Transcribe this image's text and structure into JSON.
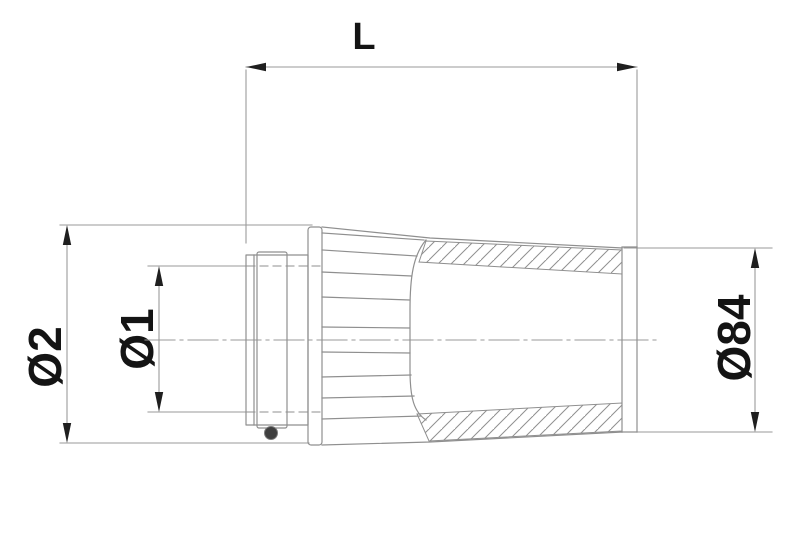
{
  "drawing": {
    "labels": {
      "length": "L",
      "flange_diameter": "Ø2",
      "inlet_diameter": "Ø1",
      "end_diameter": "Ø84"
    },
    "colors": {
      "line": "#8f8f8f",
      "dimension": "#9a9a9a",
      "arrow": "#1f1f1f",
      "text": "#141414",
      "screw": "#3f3f3f",
      "background": "#ffffff"
    }
  }
}
